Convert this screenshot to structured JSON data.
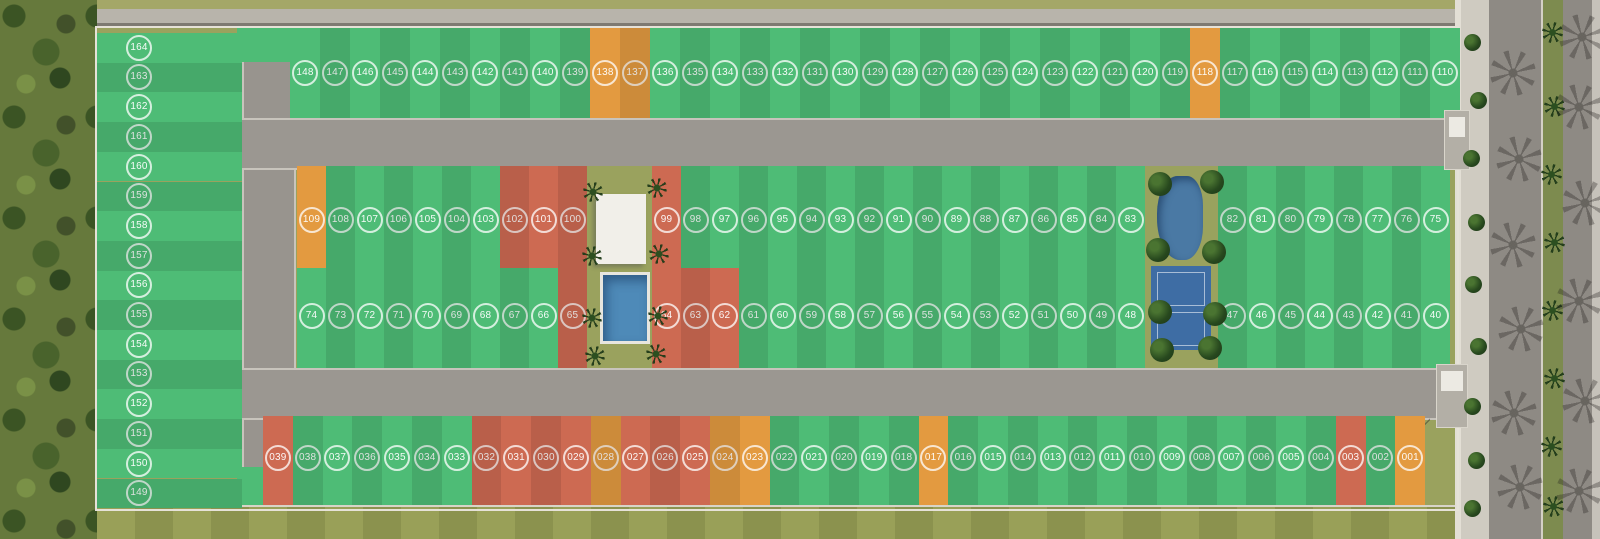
{
  "title": "residential lot master plan",
  "statuses": {
    "g": "#4ebc76",
    "o": "#e39a40",
    "r": "#cd6a52"
  },
  "status_labels": {
    "g": "green",
    "o": "orange",
    "r": "red"
  },
  "badge_ring_color": "#ffffff",
  "site": {
    "left_column": [
      [
        "164",
        "g"
      ],
      [
        "163",
        "g"
      ],
      [
        "162",
        "g"
      ],
      [
        "161",
        "g"
      ],
      [
        "160",
        "g"
      ],
      [
        "159",
        "g"
      ],
      [
        "158",
        "g"
      ],
      [
        "157",
        "g"
      ],
      [
        "156",
        "g"
      ],
      [
        "155",
        "g"
      ],
      [
        "154",
        "g"
      ],
      [
        "153",
        "g"
      ],
      [
        "152",
        "g"
      ],
      [
        "151",
        "g"
      ],
      [
        "150",
        "g"
      ],
      [
        "149",
        "g"
      ]
    ],
    "top_row": [
      [
        "148",
        "g"
      ],
      [
        "147",
        "g"
      ],
      [
        "146",
        "g"
      ],
      [
        "145",
        "g"
      ],
      [
        "144",
        "g"
      ],
      [
        "143",
        "g"
      ],
      [
        "142",
        "g"
      ],
      [
        "141",
        "g"
      ],
      [
        "140",
        "g"
      ],
      [
        "139",
        "g"
      ],
      [
        "138",
        "o"
      ],
      [
        "137",
        "o"
      ],
      [
        "136",
        "g"
      ],
      [
        "135",
        "g"
      ],
      [
        "134",
        "g"
      ],
      [
        "133",
        "g"
      ],
      [
        "132",
        "g"
      ],
      [
        "131",
        "g"
      ],
      [
        "130",
        "g"
      ],
      [
        "129",
        "g"
      ],
      [
        "128",
        "g"
      ],
      [
        "127",
        "g"
      ],
      [
        "126",
        "g"
      ],
      [
        "125",
        "g"
      ],
      [
        "124",
        "g"
      ],
      [
        "123",
        "g"
      ],
      [
        "122",
        "g"
      ],
      [
        "121",
        "g"
      ],
      [
        "120",
        "g"
      ],
      [
        "119",
        "g"
      ],
      [
        "118",
        "o"
      ],
      [
        "117",
        "g"
      ],
      [
        "116",
        "g"
      ],
      [
        "115",
        "g"
      ],
      [
        "114",
        "g"
      ],
      [
        "113",
        "g"
      ],
      [
        "112",
        "g"
      ],
      [
        "111",
        "g"
      ],
      [
        "110",
        "g"
      ]
    ],
    "middle_upper": [
      [
        [
          "109",
          "o"
        ],
        [
          "108",
          "g"
        ],
        [
          "107",
          "g"
        ],
        [
          "106",
          "g"
        ],
        [
          "105",
          "g"
        ],
        [
          "104",
          "g"
        ],
        [
          "103",
          "g"
        ],
        [
          "102",
          "r"
        ],
        [
          "101",
          "r"
        ],
        [
          "100",
          "r"
        ]
      ],
      [
        [
          "99",
          "r"
        ],
        [
          "98",
          "g"
        ],
        [
          "97",
          "g"
        ],
        [
          "96",
          "g"
        ],
        [
          "95",
          "g"
        ],
        [
          "94",
          "g"
        ],
        [
          "93",
          "g"
        ],
        [
          "92",
          "g"
        ],
        [
          "91",
          "g"
        ],
        [
          "90",
          "g"
        ],
        [
          "89",
          "g"
        ],
        [
          "88",
          "g"
        ],
        [
          "87",
          "g"
        ],
        [
          "86",
          "g"
        ],
        [
          "85",
          "g"
        ],
        [
          "84",
          "g"
        ],
        [
          "83",
          "g"
        ]
      ],
      [
        [
          "82",
          "g"
        ],
        [
          "81",
          "g"
        ],
        [
          "80",
          "g"
        ],
        [
          "79",
          "g"
        ],
        [
          "78",
          "g"
        ],
        [
          "77",
          "g"
        ],
        [
          "76",
          "g"
        ],
        [
          "75",
          "g"
        ]
      ]
    ],
    "middle_lower": [
      [
        [
          "74",
          "g"
        ],
        [
          "73",
          "g"
        ],
        [
          "72",
          "g"
        ],
        [
          "71",
          "g"
        ],
        [
          "70",
          "g"
        ],
        [
          "69",
          "g"
        ],
        [
          "68",
          "g"
        ],
        [
          "67",
          "g"
        ],
        [
          "66",
          "g"
        ],
        [
          "65",
          "r"
        ]
      ],
      [
        [
          "64",
          "r"
        ],
        [
          "63",
          "r"
        ],
        [
          "62",
          "r"
        ],
        [
          "61",
          "g"
        ],
        [
          "60",
          "g"
        ],
        [
          "59",
          "g"
        ],
        [
          "58",
          "g"
        ],
        [
          "57",
          "g"
        ],
        [
          "56",
          "g"
        ],
        [
          "55",
          "g"
        ],
        [
          "54",
          "g"
        ],
        [
          "53",
          "g"
        ],
        [
          "52",
          "g"
        ],
        [
          "51",
          "g"
        ],
        [
          "50",
          "g"
        ],
        [
          "49",
          "g"
        ],
        [
          "48",
          "g"
        ]
      ],
      [
        [
          "47",
          "g"
        ],
        [
          "46",
          "g"
        ],
        [
          "45",
          "g"
        ],
        [
          "44",
          "g"
        ],
        [
          "43",
          "g"
        ],
        [
          "42",
          "g"
        ],
        [
          "41",
          "g"
        ],
        [
          "40",
          "g"
        ]
      ]
    ],
    "bottom_row": [
      [
        "039",
        "r"
      ],
      [
        "038",
        "g"
      ],
      [
        "037",
        "g"
      ],
      [
        "036",
        "g"
      ],
      [
        "035",
        "g"
      ],
      [
        "034",
        "g"
      ],
      [
        "033",
        "g"
      ],
      [
        "032",
        "r"
      ],
      [
        "031",
        "r"
      ],
      [
        "030",
        "r"
      ],
      [
        "029",
        "r"
      ],
      [
        "028",
        "o"
      ],
      [
        "027",
        "r"
      ],
      [
        "026",
        "r"
      ],
      [
        "025",
        "r"
      ],
      [
        "024",
        "o"
      ],
      [
        "023",
        "o"
      ],
      [
        "022",
        "g"
      ],
      [
        "021",
        "g"
      ],
      [
        "020",
        "g"
      ],
      [
        "019",
        "g"
      ],
      [
        "018",
        "g"
      ],
      [
        "017",
        "o"
      ],
      [
        "016",
        "g"
      ],
      [
        "015",
        "g"
      ],
      [
        "014",
        "g"
      ],
      [
        "013",
        "g"
      ],
      [
        "012",
        "g"
      ],
      [
        "011",
        "g"
      ],
      [
        "010",
        "g"
      ],
      [
        "009",
        "g"
      ],
      [
        "008",
        "g"
      ],
      [
        "007",
        "g"
      ],
      [
        "006",
        "g"
      ],
      [
        "005",
        "g"
      ],
      [
        "004",
        "g"
      ],
      [
        "003",
        "r"
      ],
      [
        "002",
        "g"
      ],
      [
        "001",
        "o"
      ]
    ]
  },
  "amenities": [
    "clubhouse",
    "swimming-pool",
    "pond-park",
    "sports-courts"
  ]
}
